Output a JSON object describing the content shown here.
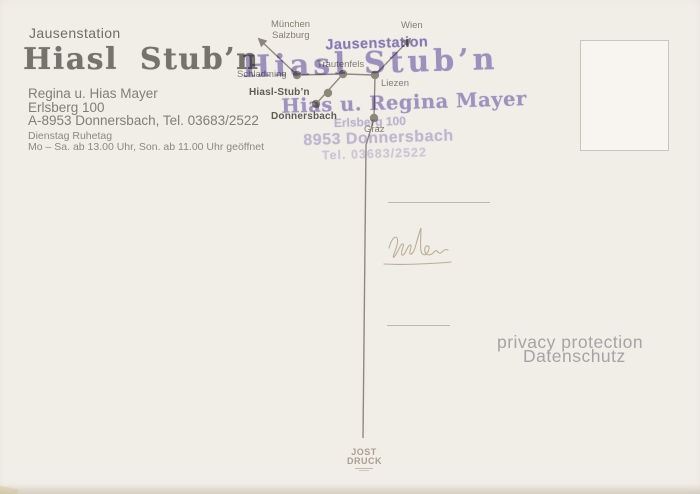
{
  "colors": {
    "background": "#f1eee8",
    "print_gray": "#76746a",
    "map_gray": "#8b8679",
    "stamp_purple": "#8f82c5",
    "privacy_gray": "#a4a4a4",
    "handwriting_tan": "#b4a78d"
  },
  "header": {
    "overline": "Jausenstation",
    "title": "Hiasl Stub’n",
    "owner": "Regina u. Hias Mayer",
    "street": "Erlsberg 100",
    "city_tel": "A-8953 Donnersbach, Tel. 03683/2522",
    "rest_day": "Dienstag Ruhetag",
    "hours": "Mo – Sa. ab 13.00 Uhr, Son. ab 11.00 Uhr geöffnet"
  },
  "map": {
    "labels": {
      "muenchen": "München",
      "salzburg": "Salzburg",
      "wien": "Wien",
      "schladming": "Schladming",
      "trautenfels": "Trautenfels",
      "liezen": "Liezen",
      "hiasl_stubn": "Hiasl-Stub’n",
      "donnersbach": "Donnersbach",
      "graz": "Graz"
    }
  },
  "stamp": {
    "line1": "Jausenstation",
    "line2": "Hiasl Stub’n",
    "line3": "Hias u. Regina Mayer",
    "line4": "Erlsberg 100",
    "line5": "8953 Donnersbach",
    "line6": "Tel. 03683/2522"
  },
  "handwriting": {
    "approx_text": "Urlau"
  },
  "privacy": {
    "line1": "privacy protection",
    "line2": "Datenschutz"
  },
  "printer": {
    "line1": "JOST",
    "line2": "DRUCK"
  }
}
